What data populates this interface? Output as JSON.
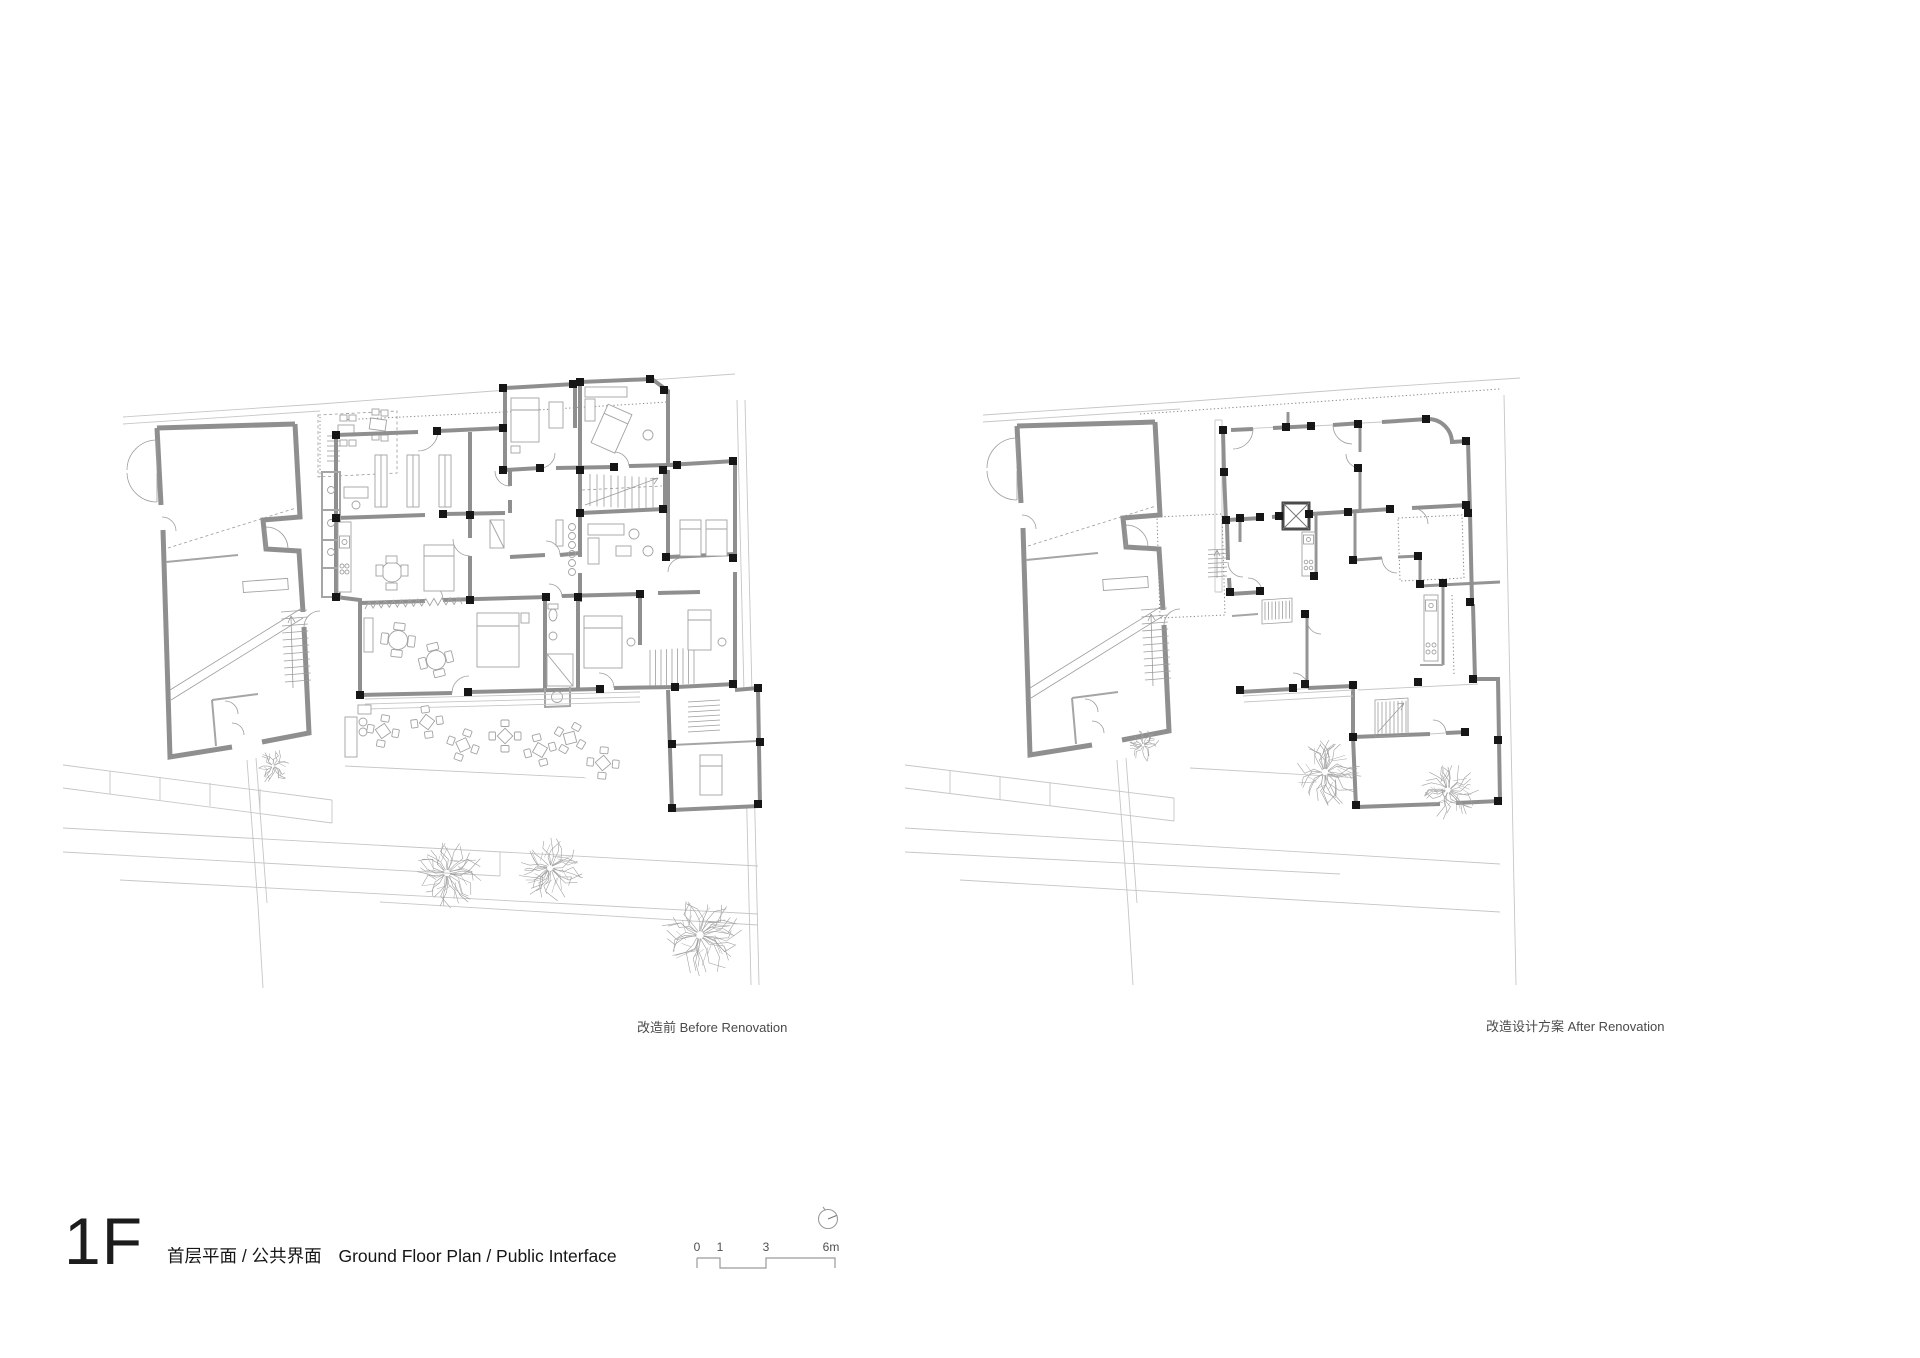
{
  "page": {
    "background": "#ffffff",
    "sheet_type": "architectural floor plan sheet"
  },
  "title_block": {
    "floor_label": "1F",
    "subtitle_zh": "首层平面 / 公共界面",
    "subtitle_en": "Ground Floor Plan / Public Interface"
  },
  "plans": {
    "before": {
      "caption": "改造前 Before Renovation"
    },
    "after": {
      "caption": "改造设计方案 After Renovation"
    }
  },
  "scale_bar": {
    "labels": [
      "0",
      "1",
      "3",
      "6m"
    ]
  },
  "icons": {
    "north_indicator": "circle-with-needle"
  },
  "colors": {
    "wall": "#8f8f8f",
    "column": "#161616",
    "context_line": "#c6c6c6",
    "furniture_line": "#a2a2a2",
    "text": "#1c1c1c",
    "caption_text": "#4a4a4a"
  }
}
